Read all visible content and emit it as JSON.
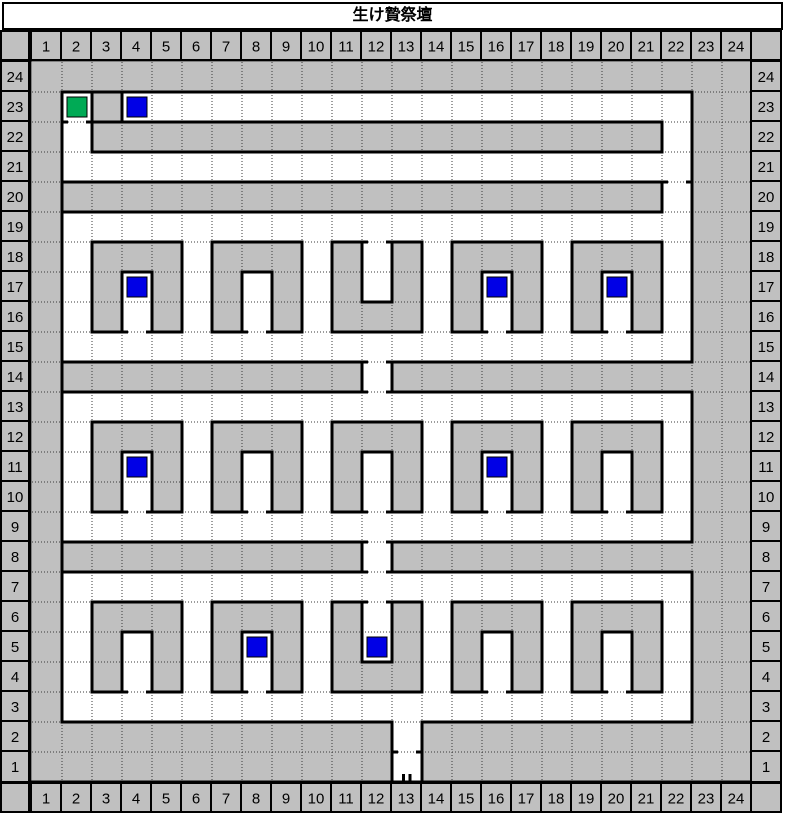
{
  "title": "生け贄祭壇",
  "columns": [
    1,
    2,
    3,
    4,
    5,
    6,
    7,
    8,
    9,
    10,
    11,
    12,
    13,
    14,
    15,
    16,
    17,
    18,
    19,
    20,
    21,
    22,
    23,
    24
  ],
  "left_labels": [
    24,
    23,
    22,
    21,
    20,
    19,
    18,
    17,
    16,
    15,
    14,
    13,
    12,
    11,
    10,
    9,
    8,
    7,
    6,
    5,
    4,
    3,
    2,
    1
  ],
  "right_labels": [
    24,
    23,
    22,
    21,
    20,
    19,
    18,
    17,
    16,
    15,
    14,
    13,
    12,
    11,
    10,
    9,
    8,
    7,
    6,
    5,
    4,
    3,
    2,
    1
  ],
  "colors": {
    "page_bg": "#FFFFFF",
    "cell_gray": "#C0C0C0",
    "floor_white": "#FFFFFF",
    "line_black": "#000000",
    "grid_dot": "#3A3A3A",
    "marker_blue": "#0000E6",
    "marker_green": "#00AA55"
  },
  "map": {
    "cols": 24,
    "rows": 24,
    "solid_rows_top_to_bottom": [
      "########################",
      "#.#...................##",
      "#.###################.##",
      "#.....................##",
      "#####################.##",
      "#.....................##",
      "#.###.###.#.#.###.###.##",
      "#.#.#.#.#.#.#.#.#.#.#.##",
      "#.#.#.#.#.###.#.#.#.#.##",
      "#.....................##",
      "###########.############",
      "#.....................##",
      "#.###.###.###.###.###.##",
      "#.#.#.#.#.#.#.#.#.#.#.##",
      "#.#.#.#.#.#.#.#.#.#.#.##",
      "#.....................##",
      "###########.############",
      "#.....................##",
      "#.###.###.#.#.###.###.##",
      "#.#.#.#.#.#.#.#.#.#.#.##",
      "#.#.#.#.#.###.#.#.#.#.##",
      "#.....................##",
      "############.###########",
      "############.###########"
    ],
    "walls": [
      [
        1,
        1,
        22,
        1
      ],
      [
        2,
        2,
        21,
        2
      ],
      [
        2,
        3,
        21,
        3
      ],
      [
        1,
        4,
        21,
        4
      ],
      [
        1,
        5,
        21,
        5
      ],
      [
        2,
        6,
        5,
        6
      ],
      [
        6,
        6,
        9,
        6
      ],
      [
        10,
        6,
        11,
        6
      ],
      [
        12,
        6,
        13,
        6
      ],
      [
        14,
        6,
        17,
        6
      ],
      [
        18,
        6,
        21,
        6
      ],
      [
        3,
        7,
        4,
        7
      ],
      [
        7,
        7,
        8,
        7
      ],
      [
        15,
        7,
        16,
        7
      ],
      [
        19,
        7,
        20,
        7
      ],
      [
        11,
        8,
        12,
        8
      ],
      [
        2,
        9,
        3,
        9
      ],
      [
        4,
        9,
        5,
        9
      ],
      [
        6,
        9,
        7,
        9
      ],
      [
        8,
        9,
        9,
        9
      ],
      [
        10,
        9,
        13,
        9
      ],
      [
        14,
        9,
        15,
        9
      ],
      [
        16,
        9,
        17,
        9
      ],
      [
        18,
        9,
        19,
        9
      ],
      [
        20,
        9,
        21,
        9
      ],
      [
        1,
        10,
        11,
        10
      ],
      [
        12,
        10,
        22,
        10
      ],
      [
        1,
        11,
        11,
        11
      ],
      [
        12,
        11,
        22,
        11
      ],
      [
        2,
        12,
        5,
        12
      ],
      [
        6,
        12,
        9,
        12
      ],
      [
        10,
        12,
        13,
        12
      ],
      [
        14,
        12,
        17,
        12
      ],
      [
        18,
        12,
        21,
        12
      ],
      [
        3,
        13,
        4,
        13
      ],
      [
        7,
        13,
        8,
        13
      ],
      [
        11,
        13,
        12,
        13
      ],
      [
        15,
        13,
        16,
        13
      ],
      [
        19,
        13,
        20,
        13
      ],
      [
        2,
        15,
        3,
        15
      ],
      [
        4,
        15,
        5,
        15
      ],
      [
        6,
        15,
        7,
        15
      ],
      [
        8,
        15,
        9,
        15
      ],
      [
        10,
        15,
        11,
        15
      ],
      [
        12,
        15,
        13,
        15
      ],
      [
        14,
        15,
        15,
        15
      ],
      [
        16,
        15,
        17,
        15
      ],
      [
        18,
        15,
        19,
        15
      ],
      [
        20,
        15,
        21,
        15
      ],
      [
        1,
        16,
        11,
        16
      ],
      [
        12,
        16,
        22,
        16
      ],
      [
        1,
        17,
        11,
        17
      ],
      [
        12,
        17,
        22,
        17
      ],
      [
        2,
        18,
        5,
        18
      ],
      [
        6,
        18,
        9,
        18
      ],
      [
        10,
        18,
        11,
        18
      ],
      [
        12,
        18,
        13,
        18
      ],
      [
        14,
        18,
        17,
        18
      ],
      [
        18,
        18,
        21,
        18
      ],
      [
        3,
        19,
        4,
        19
      ],
      [
        7,
        19,
        8,
        19
      ],
      [
        15,
        19,
        16,
        19
      ],
      [
        19,
        19,
        20,
        19
      ],
      [
        11,
        20,
        12,
        20
      ],
      [
        2,
        21,
        3,
        21
      ],
      [
        4,
        21,
        5,
        21
      ],
      [
        6,
        21,
        7,
        21
      ],
      [
        8,
        21,
        9,
        21
      ],
      [
        10,
        21,
        13,
        21
      ],
      [
        14,
        21,
        15,
        21
      ],
      [
        16,
        21,
        17,
        21
      ],
      [
        18,
        21,
        19,
        21
      ],
      [
        20,
        21,
        21,
        21
      ],
      [
        1,
        22,
        12,
        22
      ],
      [
        13,
        22,
        22,
        22
      ],
      [
        1,
        1,
        1,
        22
      ],
      [
        22,
        1,
        22,
        10
      ],
      [
        22,
        11,
        22,
        16
      ],
      [
        22,
        17,
        22,
        22
      ],
      [
        2,
        1,
        2,
        2
      ],
      [
        3,
        1,
        3,
        2
      ],
      [
        2,
        2,
        2,
        3
      ],
      [
        21,
        2,
        21,
        3
      ],
      [
        21,
        4,
        21,
        5
      ],
      [
        11,
        10,
        11,
        11
      ],
      [
        12,
        10,
        12,
        11
      ],
      [
        11,
        16,
        11,
        17
      ],
      [
        12,
        16,
        12,
        17
      ],
      [
        12,
        22,
        12,
        24
      ],
      [
        13,
        22,
        13,
        24
      ],
      [
        2,
        6,
        2,
        9
      ],
      [
        5,
        6,
        5,
        9
      ],
      [
        3,
        7,
        3,
        9
      ],
      [
        4,
        7,
        4,
        9
      ],
      [
        6,
        6,
        6,
        9
      ],
      [
        9,
        6,
        9,
        9
      ],
      [
        7,
        7,
        7,
        9
      ],
      [
        8,
        7,
        8,
        9
      ],
      [
        10,
        6,
        10,
        9
      ],
      [
        13,
        6,
        13,
        9
      ],
      [
        11,
        6,
        11,
        8
      ],
      [
        12,
        6,
        12,
        8
      ],
      [
        14,
        6,
        14,
        9
      ],
      [
        17,
        6,
        17,
        9
      ],
      [
        15,
        7,
        15,
        9
      ],
      [
        16,
        7,
        16,
        9
      ],
      [
        18,
        6,
        18,
        9
      ],
      [
        21,
        6,
        21,
        9
      ],
      [
        19,
        7,
        19,
        9
      ],
      [
        20,
        7,
        20,
        9
      ],
      [
        2,
        12,
        2,
        15
      ],
      [
        5,
        12,
        5,
        15
      ],
      [
        3,
        13,
        3,
        15
      ],
      [
        4,
        13,
        4,
        15
      ],
      [
        6,
        12,
        6,
        15
      ],
      [
        9,
        12,
        9,
        15
      ],
      [
        7,
        13,
        7,
        15
      ],
      [
        8,
        13,
        8,
        15
      ],
      [
        10,
        12,
        10,
        15
      ],
      [
        13,
        12,
        13,
        15
      ],
      [
        11,
        13,
        11,
        15
      ],
      [
        12,
        13,
        12,
        15
      ],
      [
        14,
        12,
        14,
        15
      ],
      [
        17,
        12,
        17,
        15
      ],
      [
        15,
        13,
        15,
        15
      ],
      [
        16,
        13,
        16,
        15
      ],
      [
        18,
        12,
        18,
        15
      ],
      [
        21,
        12,
        21,
        15
      ],
      [
        19,
        13,
        19,
        15
      ],
      [
        20,
        13,
        20,
        15
      ],
      [
        2,
        18,
        2,
        21
      ],
      [
        5,
        18,
        5,
        21
      ],
      [
        3,
        19,
        3,
        21
      ],
      [
        4,
        19,
        4,
        21
      ],
      [
        6,
        18,
        6,
        21
      ],
      [
        9,
        18,
        9,
        21
      ],
      [
        7,
        19,
        7,
        21
      ],
      [
        8,
        19,
        8,
        21
      ],
      [
        10,
        18,
        10,
        21
      ],
      [
        13,
        18,
        13,
        21
      ],
      [
        11,
        18,
        11,
        20
      ],
      [
        12,
        18,
        12,
        20
      ],
      [
        14,
        18,
        14,
        21
      ],
      [
        17,
        18,
        17,
        21
      ],
      [
        15,
        19,
        15,
        21
      ],
      [
        16,
        19,
        16,
        21
      ],
      [
        18,
        18,
        18,
        21
      ],
      [
        21,
        18,
        21,
        21
      ],
      [
        19,
        19,
        19,
        21
      ],
      [
        20,
        19,
        20,
        21
      ]
    ],
    "doors": [
      [
        1,
        2
      ],
      [
        21,
        4
      ],
      [
        11,
        6
      ],
      [
        3,
        9
      ],
      [
        7,
        9
      ],
      [
        15,
        9
      ],
      [
        19,
        9
      ],
      [
        11,
        10
      ],
      [
        11,
        11
      ],
      [
        3,
        15
      ],
      [
        7,
        15
      ],
      [
        11,
        15
      ],
      [
        15,
        15
      ],
      [
        19,
        15
      ],
      [
        11,
        16
      ],
      [
        11,
        17
      ],
      [
        11,
        18
      ],
      [
        3,
        21
      ],
      [
        7,
        21
      ],
      [
        15,
        21
      ],
      [
        19,
        21
      ],
      [
        12,
        23
      ]
    ],
    "exit_stubs": [
      [
        12.38,
        23.73,
        12.38,
        23.95
      ],
      [
        12.6,
        23.73,
        12.6,
        23.95
      ]
    ],
    "markers": [
      {
        "col": 2,
        "row": 23,
        "type": "green"
      },
      {
        "col": 4,
        "row": 23,
        "type": "blue"
      },
      {
        "col": 4,
        "row": 17,
        "type": "blue"
      },
      {
        "col": 16,
        "row": 17,
        "type": "blue"
      },
      {
        "col": 20,
        "row": 17,
        "type": "blue"
      },
      {
        "col": 4,
        "row": 11,
        "type": "blue"
      },
      {
        "col": 16,
        "row": 11,
        "type": "blue"
      },
      {
        "col": 8,
        "row": 5,
        "type": "blue"
      },
      {
        "col": 12,
        "row": 5,
        "type": "blue"
      }
    ]
  }
}
